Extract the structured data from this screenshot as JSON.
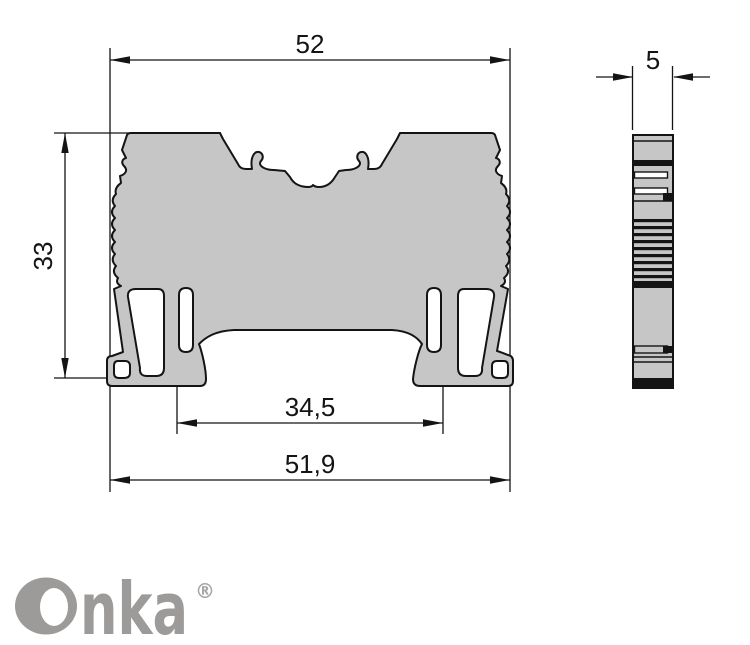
{
  "drawing": {
    "type": "technical-dimension-drawing",
    "part": "din-rail-terminal-block-profile",
    "views": [
      "front-view",
      "side-view"
    ],
    "dimensions": {
      "overall_width": "52",
      "depth": "5",
      "height": "33",
      "rail_slot_width": "34,5",
      "base_width": "51,9"
    },
    "colors": {
      "body_fill": "#c6c6c6",
      "outline": "#141414",
      "background": "#ffffff",
      "logo_gray": "#9d9a9a"
    }
  },
  "branding": {
    "logo_text": "Onka",
    "logo_text_tail": "nka",
    "registered_mark": "®"
  }
}
